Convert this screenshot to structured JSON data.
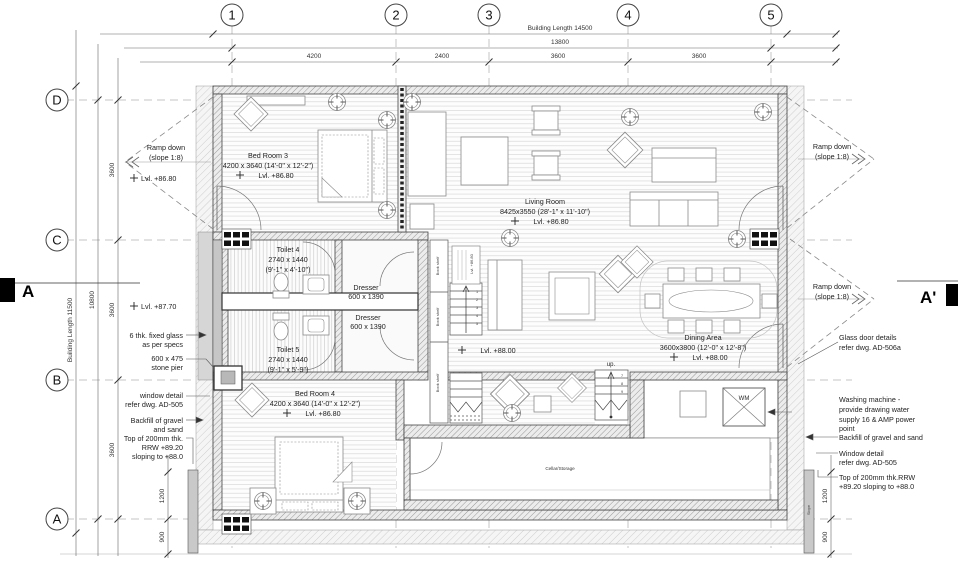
{
  "grid": {
    "cols": [
      "1",
      "2",
      "3",
      "4",
      "5"
    ],
    "rows": [
      "D",
      "C",
      "B",
      "A"
    ]
  },
  "dims": {
    "top": {
      "building_length": "Building Length 14500",
      "overall": "13800",
      "seg1": "4200",
      "seg2": "2400",
      "seg3": "3600",
      "seg4": "3600"
    },
    "left": {
      "building_length": "Building Length 11500",
      "overall": "10800",
      "seg1": "3600",
      "seg2": "3600",
      "seg3": "3600",
      "d1200": "1200",
      "d900": "900"
    },
    "right": {
      "d1200": "1200",
      "d900": "900",
      "slope": "Slope"
    }
  },
  "rooms": {
    "bedroom3": {
      "name": "Bed Room 3",
      "size": "4200 x 3640 (14'-0\" x 12'-2\")",
      "level": "Lvl. +86.80"
    },
    "living": {
      "name": "Living Room",
      "size": "8425x3550 (28'-1\" x 11'-10\")",
      "level": "Lvl. +86.80"
    },
    "toilet4": {
      "name": "Toilet 4",
      "size": "2740 x 1440",
      "size_ft": "(9'-1\" x 4'-10\")"
    },
    "toilet5": {
      "name": "Toilet 5",
      "size": "2740 x 1440",
      "size_ft": "(9'-1\" x 5'-9\")"
    },
    "dresser1": {
      "name": "Dresser",
      "size": "600 x 1390"
    },
    "dresser2": {
      "name": "Dresser",
      "size": "600 x 1390"
    },
    "hall": {
      "level": "Lvl. +88.00"
    },
    "dining": {
      "name": "Dining Area",
      "size": "3600x3800 (12'-0\" x 12'-8\")",
      "level": "Lvl. +88.00"
    },
    "bedroom4": {
      "name": "Bed Room 4",
      "size": "4200 x 3640 (14'-0\" x 12'-2\")",
      "level": "Lvl. +86.80"
    },
    "cellar": "Cellar/Storage",
    "wm": "WM",
    "up": "up.",
    "bookshelf1": "Book shelf",
    "bookshelf2": "Book shelf",
    "bookshelf3": "Book shelf",
    "stair_note": "Lvl. +86.80"
  },
  "stairs": {
    "upper": [
      "1",
      "2",
      "3",
      "4",
      "5"
    ],
    "right": [
      "7",
      "8",
      "9"
    ]
  },
  "left_notes": {
    "ramp_line1": "Ramp down",
    "ramp_line2": "(slope 1:8)",
    "lvl_d": "Lvl. +86.80",
    "lvl_c": "Lvl. +87.70",
    "glass1": "6 thk. fixed glass",
    "glass2": "as per specs",
    "pier1": "600 x 475",
    "pier2": "stone pier",
    "window1": "window detail",
    "window2": "refer dwg. AD-505",
    "backfill1": "Backfill of gravel",
    "backfill2": "and sand",
    "rrw1": "Top of 200mm thk.",
    "rrw2": "RRW +89.20",
    "rrw3": "sloping to +88.0"
  },
  "right_notes": {
    "ramp1_line1": "Ramp down",
    "ramp1_line2": "(slope 1:8)",
    "ramp2_line1": "Ramp down",
    "ramp2_line2": "(slope 1:8)",
    "glassdoor1": "Glass door details",
    "glassdoor2": "refer dwg. AD-506a",
    "washing1": "Washing machine -",
    "washing2": "provide drawing water",
    "washing3": "supply 16 & AMP power",
    "washing4": "point",
    "backfill": "Backfill of gravel and sand",
    "window1": "Window detail",
    "window2": "refer dwg. AD-505",
    "rrw1": "Top of 200mm thk.RRW",
    "rrw2": "+89.20 sloping to +88.0"
  },
  "sections": {
    "left": "A",
    "right": "A'"
  },
  "colors": {
    "line": "#444444",
    "hatch": "#8f8f8f",
    "floorline": "#d9d9d9",
    "glass": "#d6d6d6"
  }
}
